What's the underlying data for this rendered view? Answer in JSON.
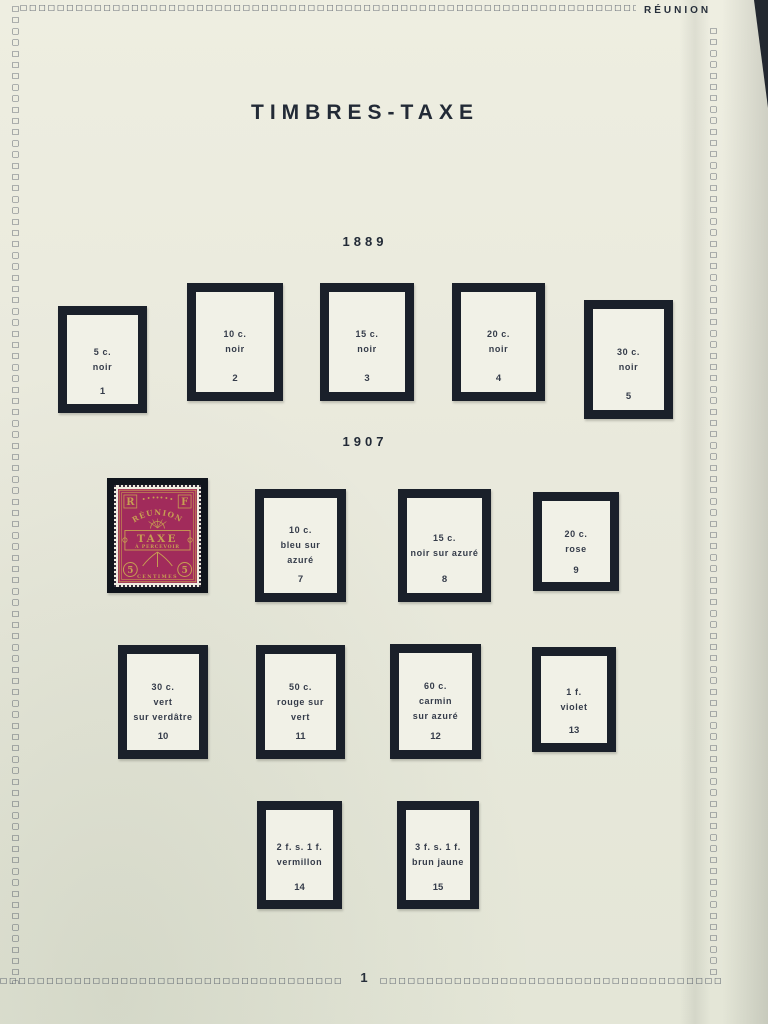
{
  "page": {
    "region": "RÉUNION",
    "title": "TIMBRES-TAXE",
    "number": "1"
  },
  "sections": [
    {
      "year": "1889"
    },
    {
      "year": "1907"
    }
  ],
  "boxes": {
    "1": {
      "value": "5 c.",
      "color": "noir",
      "number": "1"
    },
    "2": {
      "value": "10 c.",
      "color": "noir",
      "number": "2"
    },
    "3": {
      "value": "15 c.",
      "color": "noir",
      "number": "3"
    },
    "4": {
      "value": "20 c.",
      "color": "noir",
      "number": "4"
    },
    "5": {
      "value": "30 c.",
      "color": "noir",
      "number": "5"
    },
    "7": {
      "value": "10 c.",
      "color": "bleu sur azuré",
      "number": "7"
    },
    "8": {
      "value": "15 c.",
      "color": "noir sur azuré",
      "number": "8"
    },
    "9": {
      "value": "20 c.",
      "color": "rose",
      "number": "9"
    },
    "10": {
      "value": "30 c.",
      "color": "vert\nsur verdâtre",
      "number": "10"
    },
    "11": {
      "value": "50 c.",
      "color": "rouge sur vert",
      "number": "11"
    },
    "12": {
      "value": "60 c.",
      "color": "carmin\nsur azuré",
      "number": "12"
    },
    "13": {
      "value": "1 f.",
      "color": "violet",
      "number": "13"
    },
    "14": {
      "value": "2 f. s. 1 f.",
      "color": "vermillon",
      "number": "14"
    },
    "15": {
      "value": "3 f. s. 1 f.",
      "color": "brun jaune",
      "number": "15"
    }
  },
  "stamp": {
    "letter_left": "R",
    "letter_right": "F",
    "country": "RÉUNION",
    "word_taxe": "TAXE",
    "word_percevoir": "À PERCEVOIR",
    "value_left": "5",
    "value_right": "5",
    "unit": "CENTIMES"
  },
  "colors": {
    "page_background": "#e9e9dd",
    "chain_border": "#444c5b",
    "mount_frame": "#1a202a",
    "stamp_ink": "#a12b5b",
    "stamp_paper": "#c79e52"
  }
}
